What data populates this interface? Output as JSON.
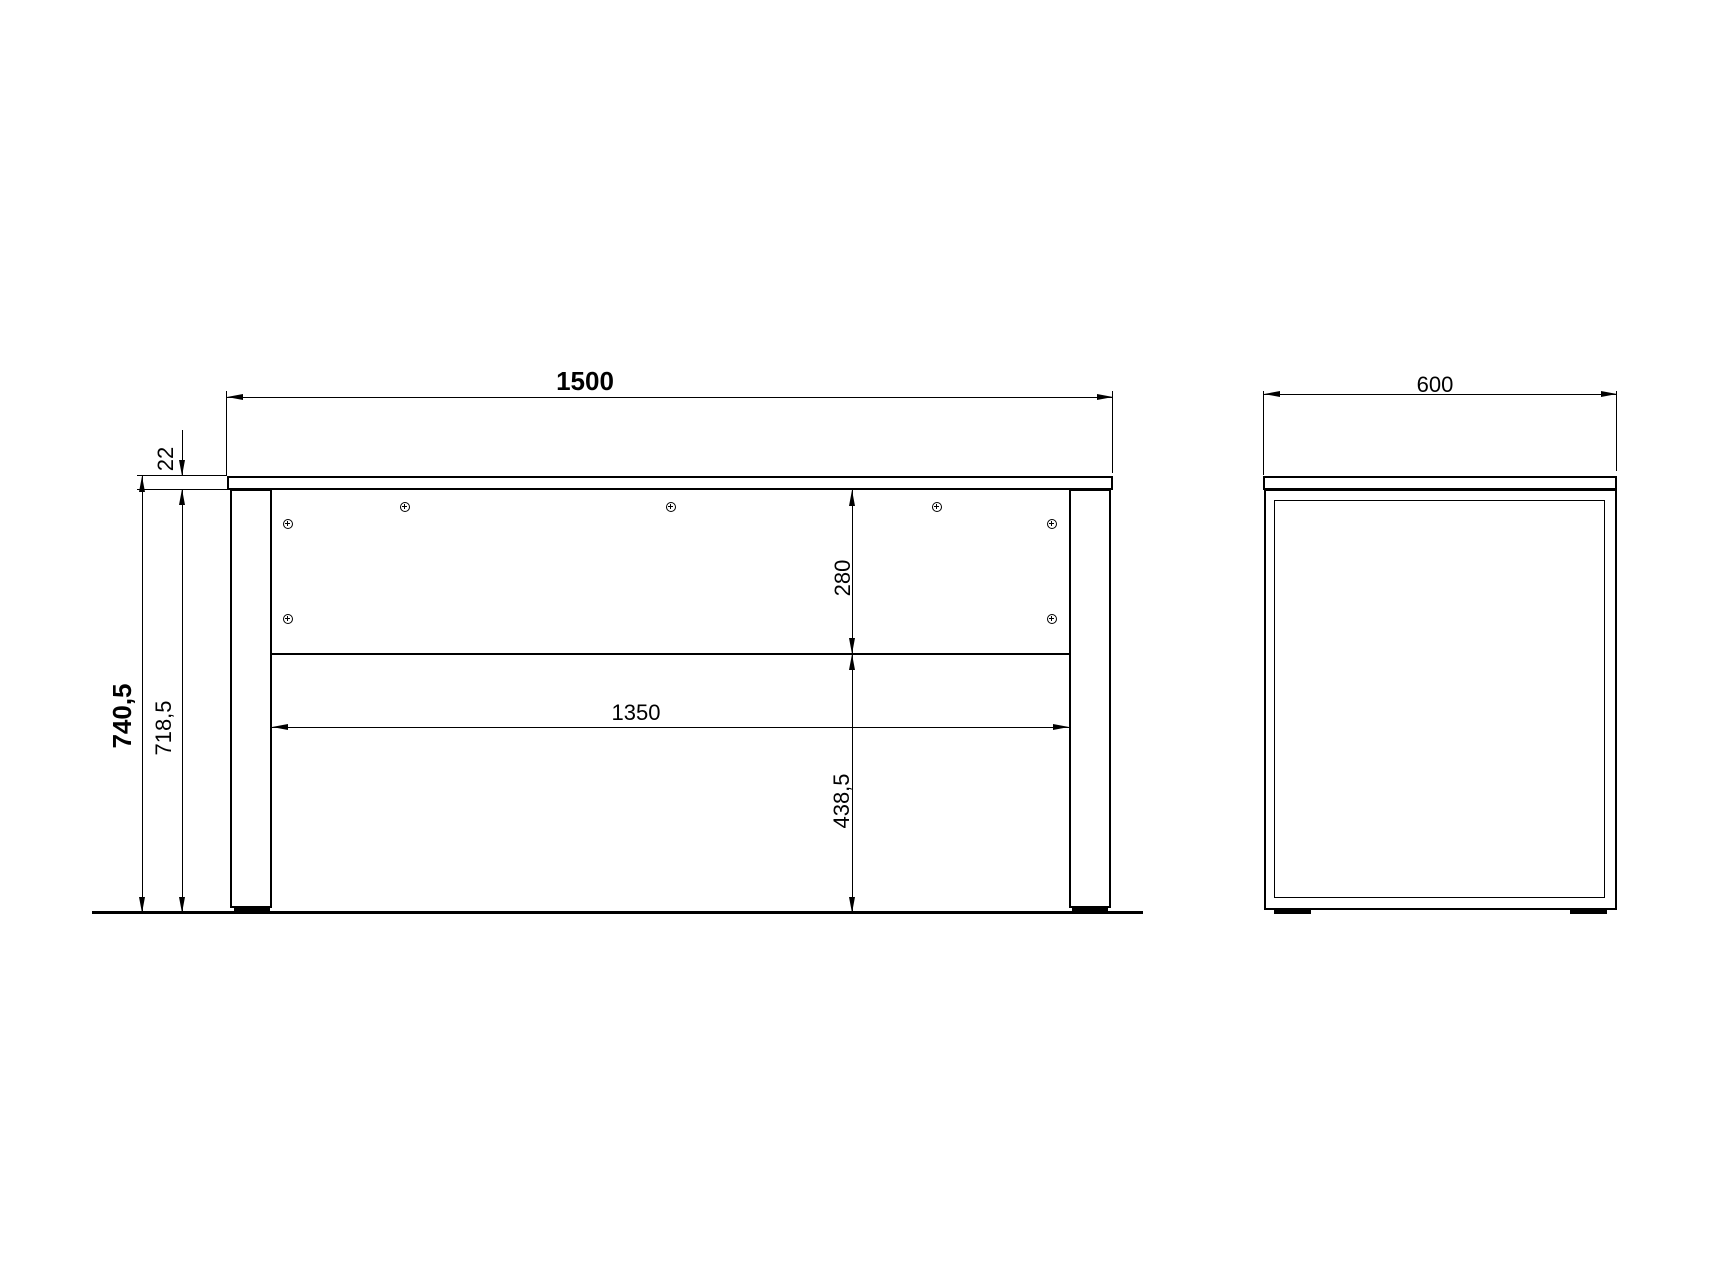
{
  "colors": {
    "line": "#000000",
    "background": "#ffffff"
  },
  "front_view": {
    "width": "1500",
    "top_thickness": "22",
    "total_height": "740,5",
    "underframe_height": "718,5",
    "back_panel_height": "280",
    "clearance_height": "438,5",
    "inner_width": "1350"
  },
  "side_view": {
    "depth": "600"
  }
}
